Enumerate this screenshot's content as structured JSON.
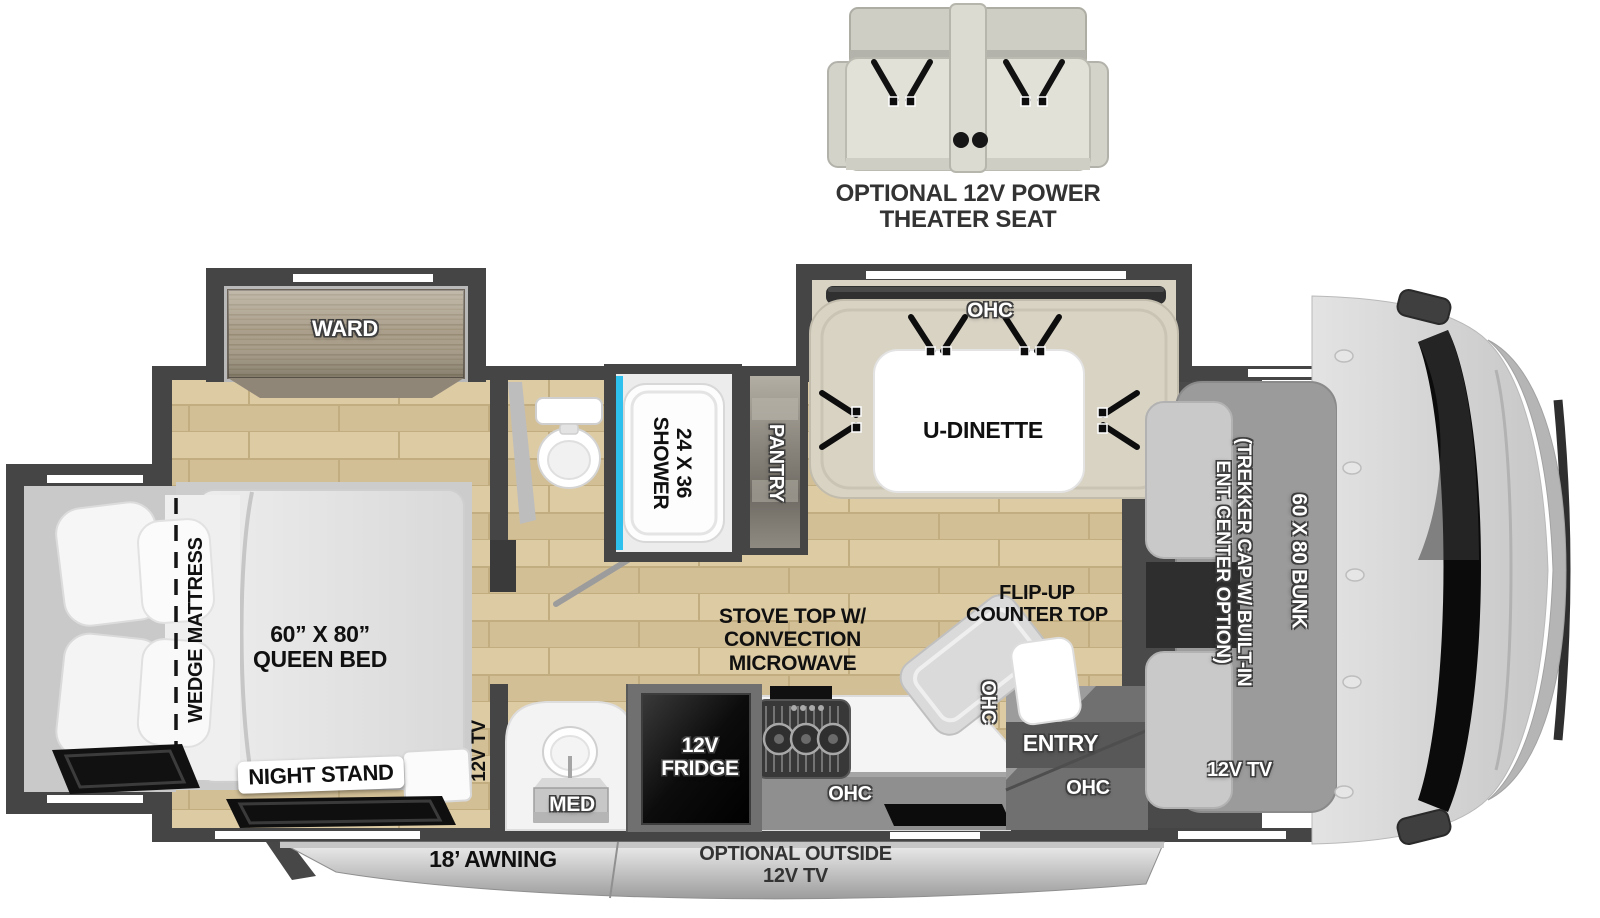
{
  "seat": {
    "label": "OPTIONAL 12V POWER\nTHEATER SEAT"
  },
  "bedroom": {
    "ward": "WARD",
    "wedge_mattress": "WEDGE MATTRESS",
    "queen_bed": "60” X 80”\nQUEEN BED",
    "night_stand": "NIGHT STAND",
    "tv": "12V TV"
  },
  "bathroom": {
    "shower": "24 X 36\nSHOWER",
    "med": "MED"
  },
  "kitchen": {
    "pantry": "PANTRY",
    "fridge": "12V\nFRIDGE",
    "stove": "STOVE TOP W/\nCONVECTION\nMICROWAVE",
    "flip_counter": "FLIP-UP\nCOUNTER TOP",
    "ohc_counter": "OHC",
    "ohc_flip": "OHC"
  },
  "dinette": {
    "label": "U-DINETTE",
    "ohc": "OHC"
  },
  "entry": {
    "label": "ENTRY",
    "ohc": "OHC"
  },
  "front": {
    "bunk": "60 X 80 BUNK",
    "trekker": "(TREKKER CAP W/ BUILT-IN\nENT. CENTER OPTION)",
    "tv": "12V TV"
  },
  "exterior": {
    "awning": "18’ AWNING",
    "outside_tv": "OPTIONAL OUTSIDE\n12V TV"
  }
}
